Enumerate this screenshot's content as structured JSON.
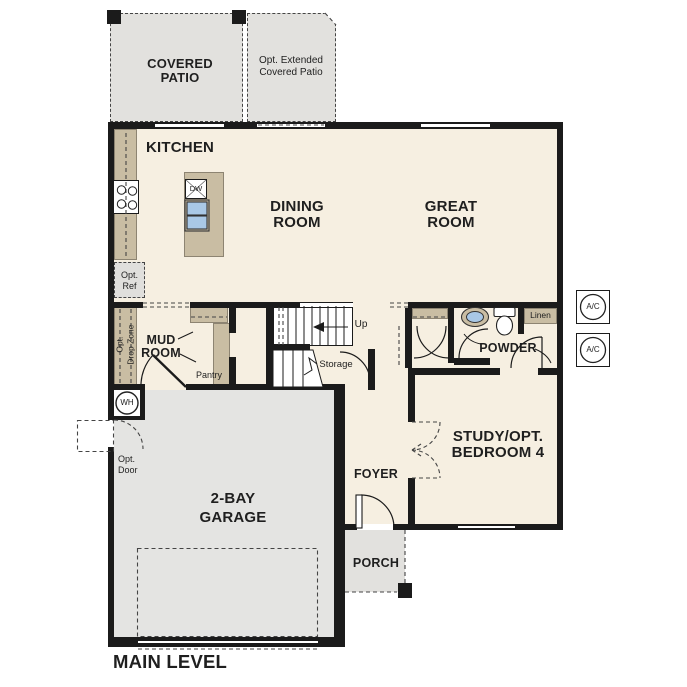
{
  "plan_title": "MAIN LEVEL",
  "labels": {
    "covered_patio": [
      "COVERED",
      "PATIO"
    ],
    "opt_extended_patio": [
      "Opt. Extended",
      "Covered Patio"
    ],
    "kitchen": [
      "KITCHEN"
    ],
    "dining_room": [
      "DINING",
      "ROOM"
    ],
    "great_room": [
      "GREAT",
      "ROOM"
    ],
    "opt_ref": [
      "Opt.",
      "Ref"
    ],
    "opt_drop_zone": [
      "Opt.",
      "Drop Zone"
    ],
    "mud_room": [
      "MUD",
      "ROOM"
    ],
    "pantry": [
      "Pantry"
    ],
    "up": [
      "Up"
    ],
    "storage": [
      "Storage"
    ],
    "powder": [
      "POWDER"
    ],
    "linen": [
      "Linen"
    ],
    "dishwasher": [
      "DW"
    ],
    "water_heater": [
      "WH"
    ],
    "ac_unit": [
      "A/C"
    ],
    "opt_door": [
      "Opt.",
      "Door"
    ],
    "study": [
      "STUDY/OPT.",
      "BEDROOM 4"
    ],
    "foyer": [
      "FOYER"
    ],
    "porch": [
      "PORCH"
    ],
    "garage": [
      "2-BAY",
      "GARAGE"
    ],
    "main_level": [
      "MAIN LEVEL"
    ]
  },
  "colors": {
    "floor": "#f6efe1",
    "patio": "#e2e1de",
    "garage": "#e4e4e2",
    "cabinet": "#c9bda3",
    "wall": "#1b1b1b",
    "sink_blue": "#a9c8e6",
    "text": "#1f1f1f"
  }
}
